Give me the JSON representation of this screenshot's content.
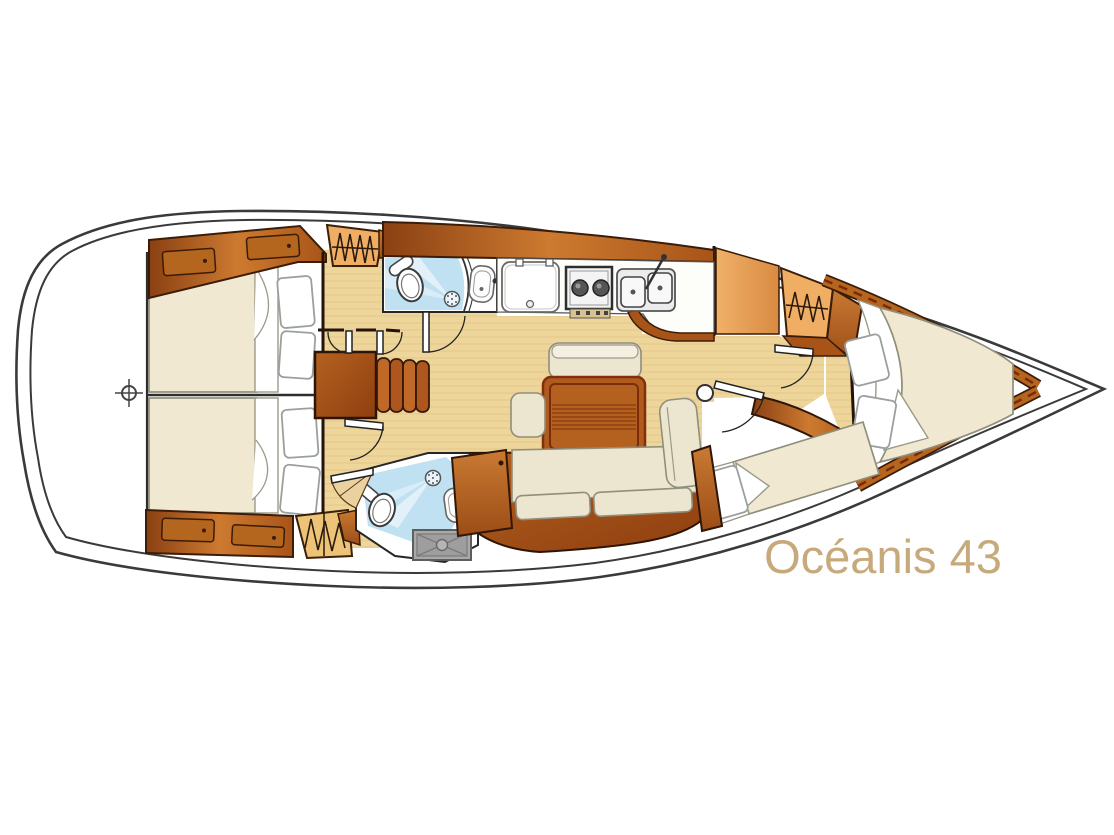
{
  "title": {
    "text": "Océanis 43"
  },
  "colors": {
    "title_text": "#c7aa7b",
    "hull_outline": "#3a3a3a",
    "floor": "#eed59a",
    "floor_grain": "#dcbe82",
    "wood_dark": "#5a2a0e",
    "wood_mid": "#b4651e",
    "wood_light": "#d98a3f",
    "locker_fill": "#efae63",
    "mattress": "#f1e8d2",
    "cushion": "#ece6d1",
    "pillow": "#ffffff",
    "head_floor": "#bfe1f2",
    "shower_tray": "#a9a9a9"
  }
}
